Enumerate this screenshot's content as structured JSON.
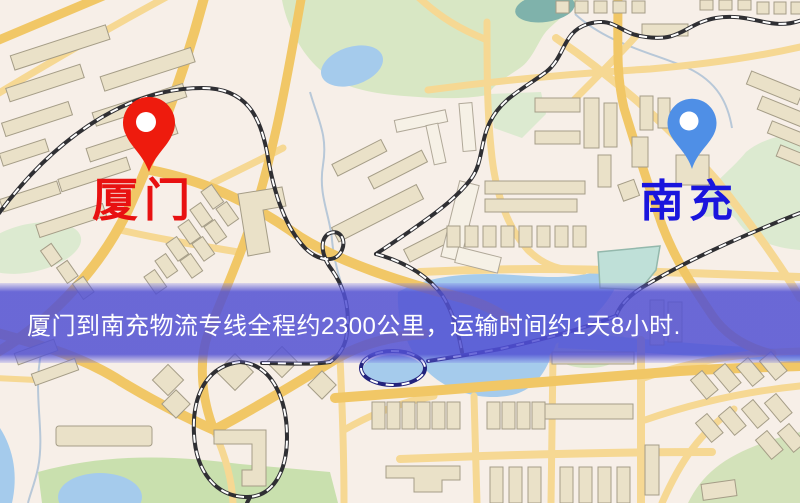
{
  "map": {
    "origin": {
      "name": "厦门",
      "marker_color": "#ee1b0d",
      "label_color": "#e81111"
    },
    "destination": {
      "name": "南充",
      "marker_color": "#4f8fe6",
      "label_color": "#1a15dd"
    },
    "banner": {
      "text": "厦门到南充物流专线全程约2300公里，运输时间约1天8小时.",
      "bg_color": "#5251d3",
      "text_color": "#ffffff"
    },
    "palette": {
      "map_background": "#f7efe8",
      "road_major": "#f1c766",
      "road_minor": "#f6d893",
      "building_fill": "#eae1c8",
      "building_outline": "#a59d87",
      "building_white": "#f6f1e6",
      "park_green": "#d8e7c4",
      "field_green": "#c9e0ae",
      "hill_green": "#d3e2ba",
      "water_blue": "#a5cbec",
      "pond_teal": "#7fb2ab",
      "pool_teal": "#bfe0d8",
      "railway_dark": "#2f2f33",
      "railway_navy": "#23237d",
      "stream_gray": "#b8c8d8"
    }
  }
}
